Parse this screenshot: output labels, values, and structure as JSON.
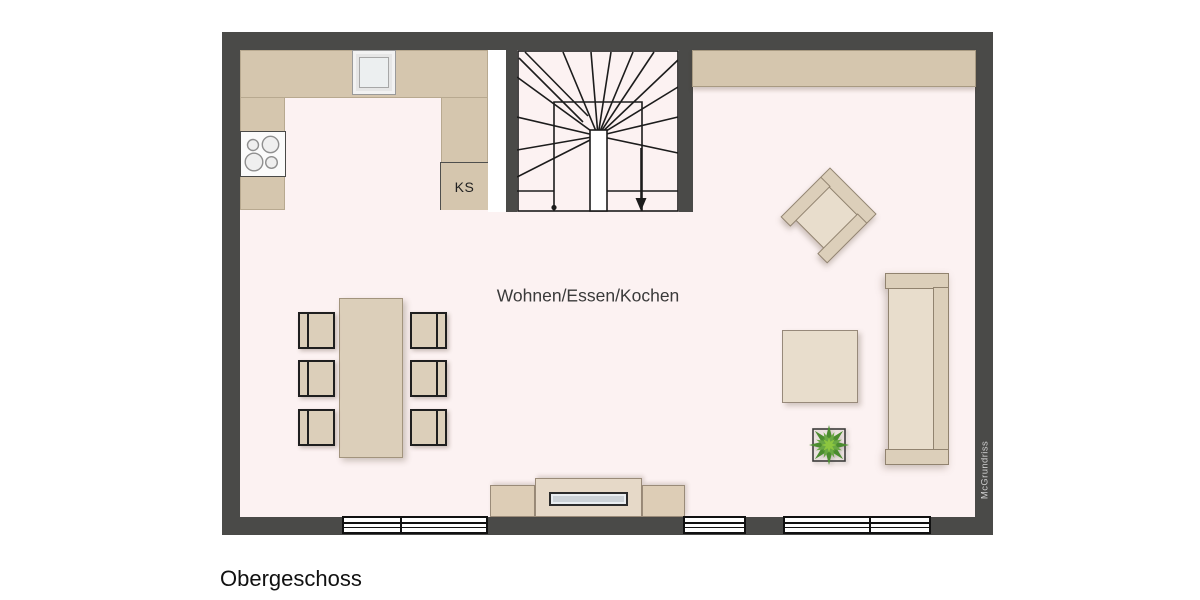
{
  "floor_title": "Obergeschoss",
  "room": {
    "label": "Wohnen/Essen/Kochen"
  },
  "kitchen": {
    "fridge_label": "KS"
  },
  "watermark": "McGrundriss",
  "colors": {
    "wall": "#4a4a48",
    "floor": "#fcf2f2",
    "outside": "#ffffff",
    "counter": "#d5c6ae",
    "counter_edge": "#a89a82",
    "furniture": "#dccfba",
    "furniture_light": "#e8ddcc",
    "furniture_edge": "#91836f",
    "line": "#1c1c1c",
    "window_fill": "#ffffff",
    "tv_screen": "#ccd2d7",
    "plant_dark": "#4b8c2f",
    "plant_mid": "#6aa844",
    "plant_light": "#8cc63f",
    "text": "#3a3a3a",
    "title": "#111111",
    "watermark_text": "#cfcfcf"
  }
}
